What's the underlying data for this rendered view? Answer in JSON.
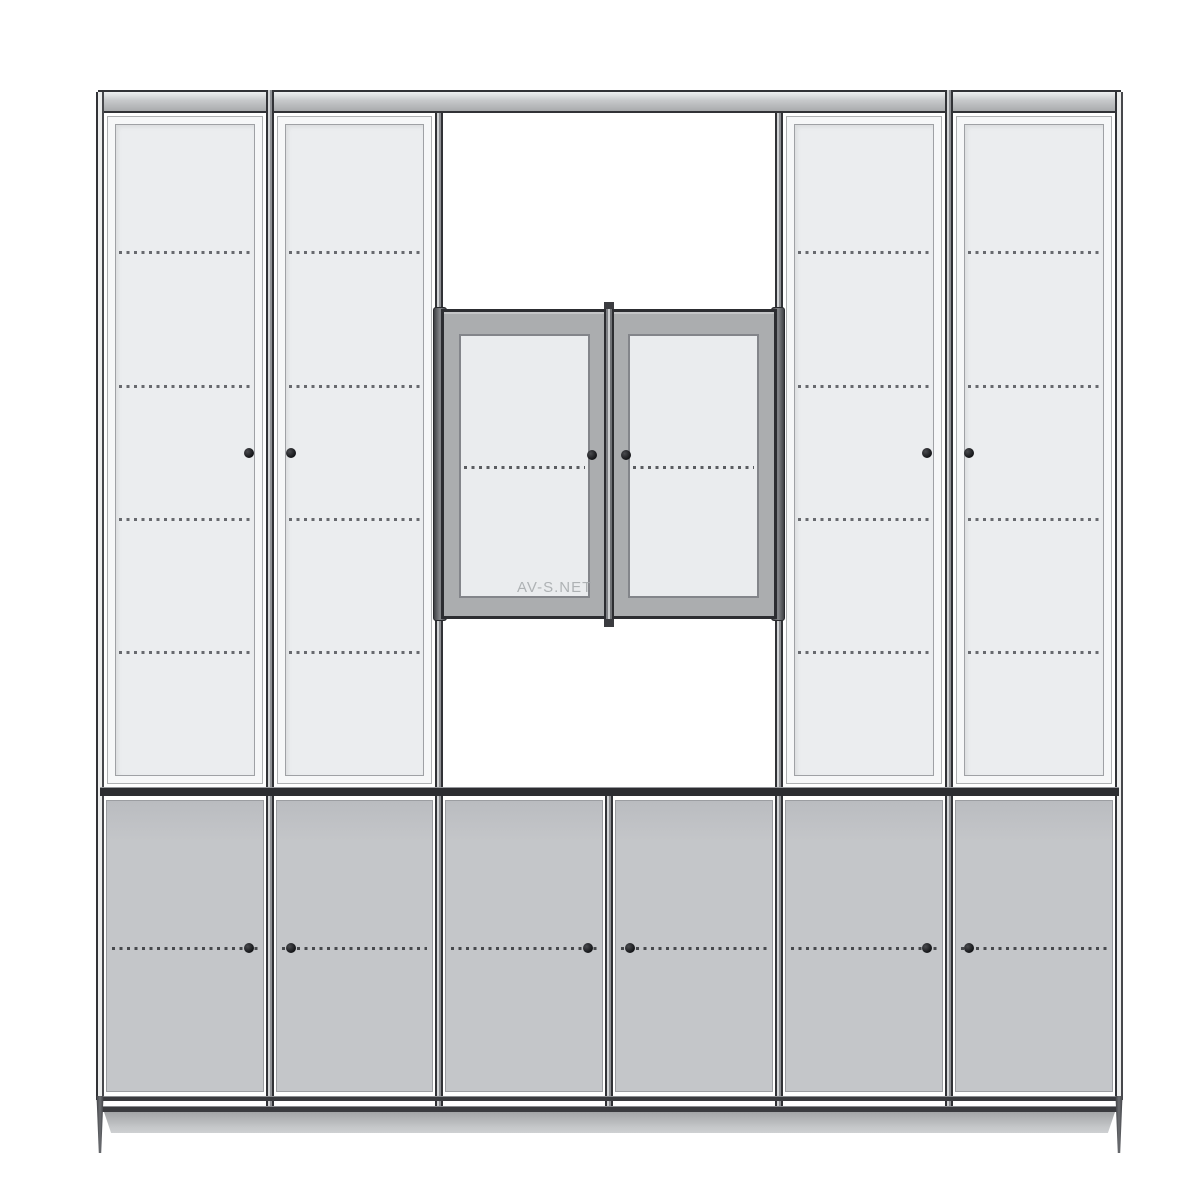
{
  "watermark": {
    "text": "AV-S.NET"
  },
  "colors": {
    "background": "#ffffff",
    "outline": "#313236",
    "rail_dark": "#2c2d31",
    "rail_highlight": "#95979b",
    "top_bar_light": "#eef0f1",
    "top_bar_mid": "#c6c8ca",
    "top_bar_deep": "#a9abad",
    "door_face": "#f6f7f8",
    "upper_panel": "#ebedef",
    "upper_panel_border": "#9fa1a5",
    "display_frame": "#abadaf",
    "display_panel": "#eaecee",
    "display_panel_border": "#83858a",
    "bottom_door": "#c4c6c9",
    "bottom_door_border": "#9b9da1",
    "shelf_dash": "#67696e",
    "shelf_dash_dark": "#46484c",
    "knob": "#131417",
    "plinth_top": "#a2a4a6",
    "plinth_bottom": "#ced0d2"
  },
  "drawing": {
    "type": "wardrobe-front-elevation",
    "columns": 6,
    "dividers_x": [
      100,
      270,
      439,
      609,
      779,
      949,
      1119
    ],
    "top_bar": {
      "y1": 90,
      "y2": 113
    },
    "upper_section": {
      "y1": 113,
      "y2": 787,
      "door_cols": [
        0,
        1,
        4,
        5
      ],
      "door_inset": 7,
      "panel_inset": 8,
      "shelf_lines_y": [
        252,
        386,
        519,
        652
      ]
    },
    "display_unit": {
      "x1": 441,
      "x2": 777,
      "y1": 309,
      "y2": 619,
      "stile_x1": 604,
      "stile_x2": 614,
      "panel_top": 334,
      "panel_bottom": 598,
      "panels_x": [
        [
          459,
          590
        ],
        [
          628,
          759
        ]
      ],
      "shelf_line_y": 467,
      "stub_above_y1": 302,
      "stub_below_y2": 627,
      "side_profiles_x": [
        [
          433,
          447
        ],
        [
          771,
          785
        ]
      ]
    },
    "mid_rail": {
      "y1": 787,
      "y2": 796
    },
    "bottom_section": {
      "y1": 796,
      "y2": 1096,
      "door_top": 800,
      "door_bottom": 1092,
      "door_inset": 6,
      "shelf_line_y": 948
    },
    "bottom_rails": [
      {
        "y1": 1096,
        "y2": 1101
      },
      {
        "y1": 1106,
        "y2": 1112
      }
    ],
    "plinth": {
      "x1": 104,
      "x2": 1115,
      "y1": 1112,
      "y2": 1133
    },
    "feet": [
      {
        "x": 95,
        "w": 10
      },
      {
        "x": 1114,
        "w": 10
      }
    ],
    "feet_y": {
      "y1": 1096,
      "y2": 1153
    },
    "post_segments": [
      {
        "x": 100,
        "y1": 92,
        "y2": 1100,
        "edge": true
      },
      {
        "x": 270,
        "y1": 90,
        "y2": 1112,
        "edge": false
      },
      {
        "x": 439,
        "y1": 113,
        "y2": 1112,
        "edge": false
      },
      {
        "x": 609,
        "y1": 788,
        "y2": 1112,
        "edge": false
      },
      {
        "x": 779,
        "y1": 113,
        "y2": 1112,
        "edge": false
      },
      {
        "x": 949,
        "y1": 90,
        "y2": 1112,
        "edge": false
      },
      {
        "x": 1119,
        "y1": 92,
        "y2": 1100,
        "edge": true
      }
    ],
    "knobs": [
      [
        249,
        453
      ],
      [
        291,
        453
      ],
      [
        927,
        453
      ],
      [
        969,
        453
      ],
      [
        592,
        455
      ],
      [
        626,
        455
      ],
      [
        249,
        948
      ],
      [
        291,
        948
      ],
      [
        588,
        948
      ],
      [
        630,
        948
      ],
      [
        927,
        948
      ],
      [
        969,
        948
      ]
    ]
  }
}
